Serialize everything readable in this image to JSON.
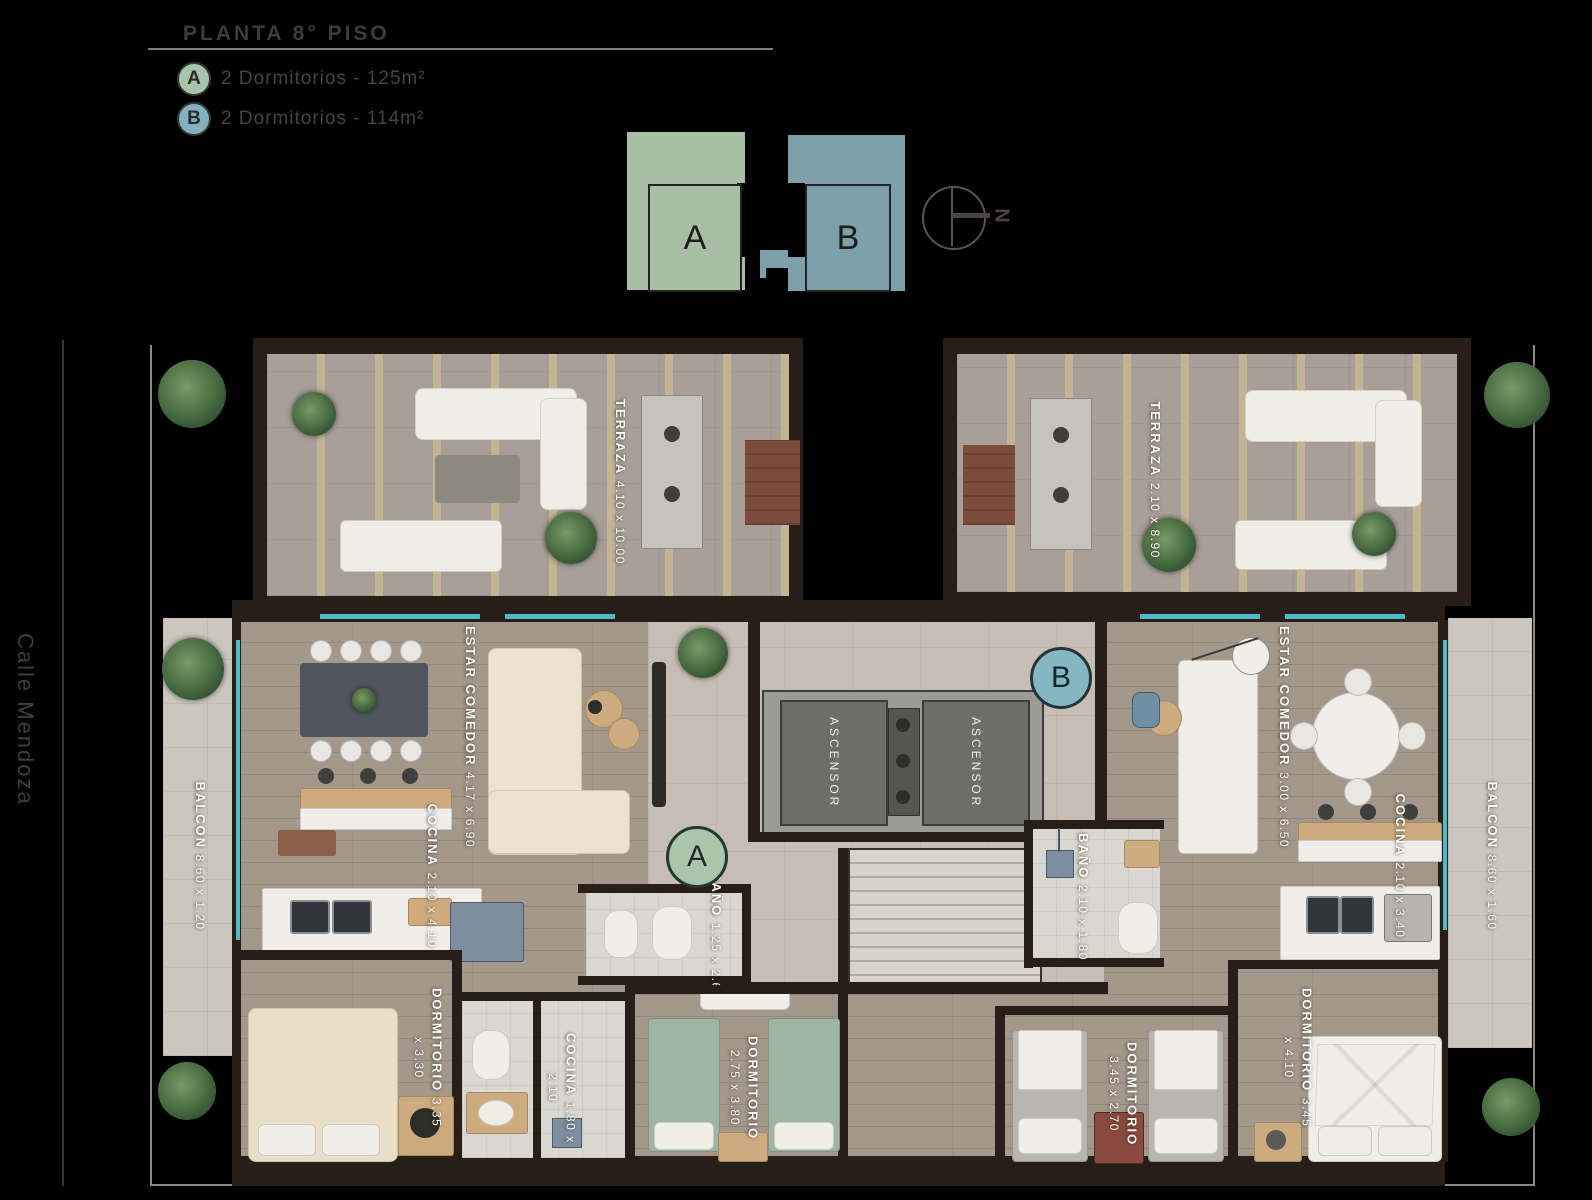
{
  "header": {
    "title": "PLANTA 8° PISO",
    "legend": [
      {
        "key": "A",
        "label": "2 Dormitorios - 125m²"
      },
      {
        "key": "B",
        "label": "2 Dormitorios - 114m²"
      }
    ]
  },
  "key_plan": {
    "unit_a_letter": "A",
    "unit_b_letter": "B",
    "north_label": "N"
  },
  "street_label": "Calle Mendoza",
  "unit_markers": {
    "a": "A",
    "b": "B"
  },
  "rooms": {
    "terraza_a": {
      "name": "TERRAZA",
      "dims": "4.10 x 10.00"
    },
    "terraza_b": {
      "name": "TERRAZA",
      "dims": "2.10 x 8.90"
    },
    "estar_comedor_a": {
      "name": "ESTAR COMEDOR",
      "dims": "4.17 x 6.90"
    },
    "estar_comedor_b": {
      "name": "ESTAR COMEDOR",
      "dims": "3.00 x 6.50"
    },
    "cocina_a": {
      "name": "COCINA",
      "dims": "2.10 x 4.10"
    },
    "cocina_b": {
      "name": "COCINA",
      "dims": "2.10 x 3.40"
    },
    "cocina_small": {
      "name": "COCINA",
      "dims": "1.80 x 2.10"
    },
    "balcon_a": {
      "name": "BALCON",
      "dims": "8.60 x 1.20"
    },
    "balcon_b": {
      "name": "BALCON",
      "dims": "8.60 x 1.60"
    },
    "bano_a": {
      "name": "BAÑO",
      "dims": "1.25 x 2.60"
    },
    "bano_b": {
      "name": "BAÑO",
      "dims": "2.10 x 1.80"
    },
    "dormitorio_a1": {
      "name": "DORMITORIO",
      "dims": "3.35 x 3.30"
    },
    "dormitorio_a2": {
      "name": "DORMITORIO",
      "dims": "2.75 x 3.80"
    },
    "dormitorio_b1": {
      "name": "DORMITORIO",
      "dims": "3.45 x 2.70"
    },
    "dormitorio_b2": {
      "name": "DORMITORIO",
      "dims": "3.45 x 4.10"
    },
    "ascensor_1": {
      "name": "ASCENSOR"
    },
    "ascensor_2": {
      "name": "ASCENSOR"
    }
  },
  "colors": {
    "background": "#000000",
    "unit_a_accent": "#a9bfa5",
    "unit_b_accent": "#7da0ab",
    "marker_a_fill": "#a9c6ab",
    "marker_b_fill": "#85b7c0",
    "glass": "#4fb8c9",
    "wall": "#261e17"
  }
}
